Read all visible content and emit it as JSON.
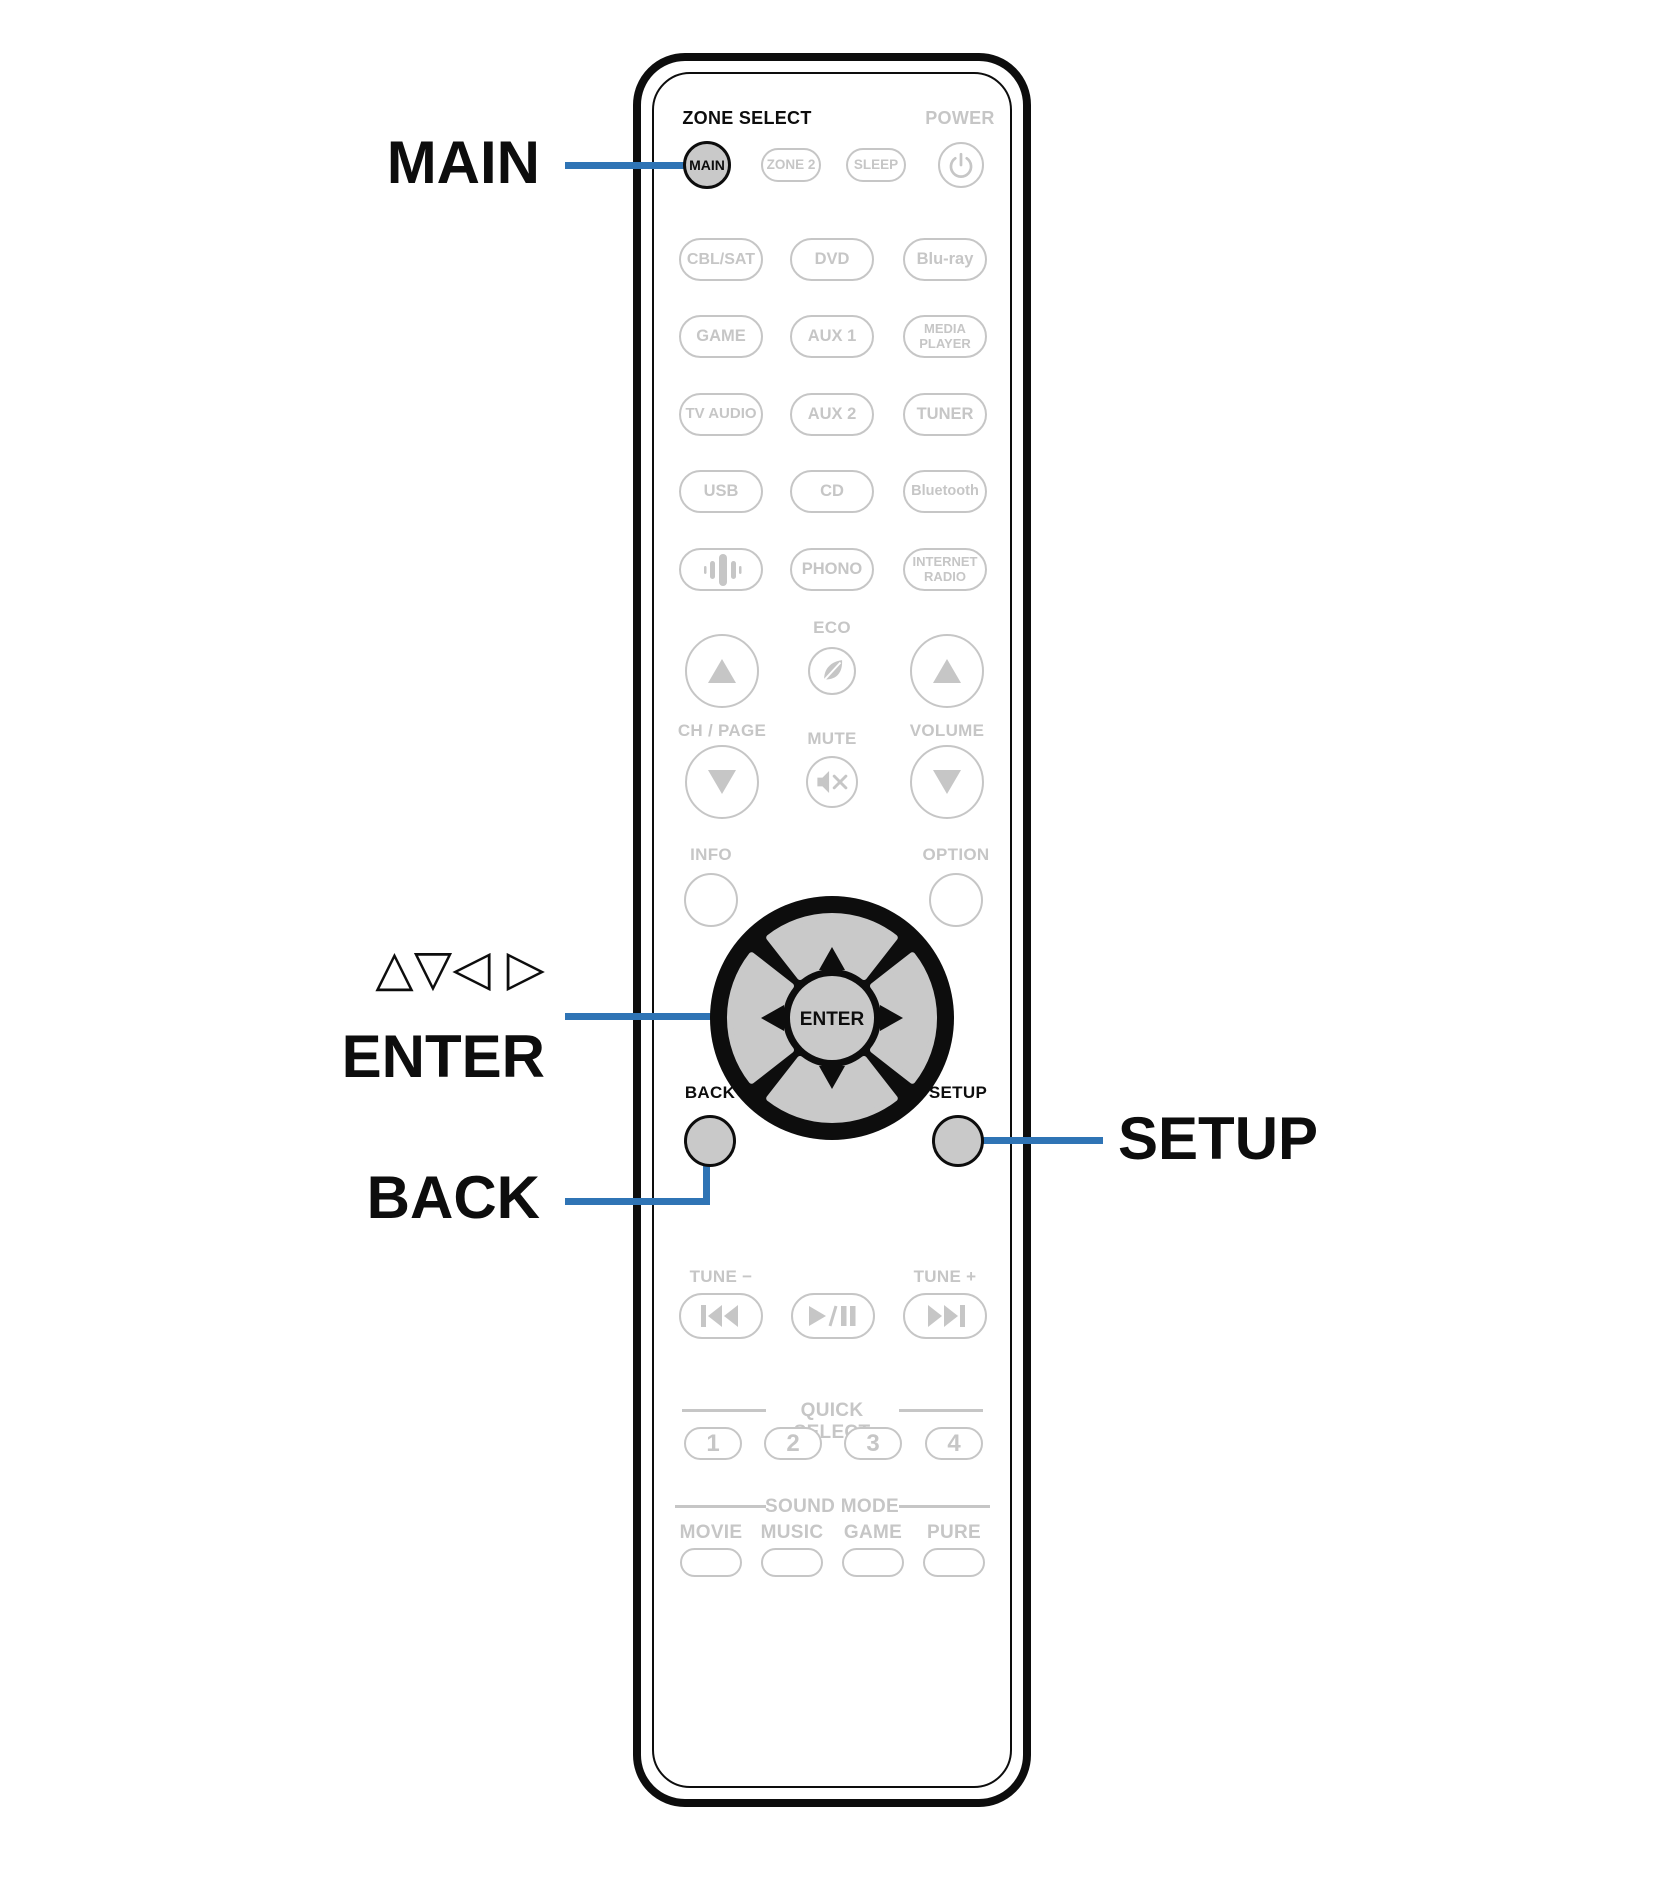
{
  "colors": {
    "accent_blue": "#2F74B5",
    "inactive_gray": "#C6C6C6",
    "button_fill_gray": "#C9C9C9",
    "outline_black": "#0D0D0D"
  },
  "callouts": {
    "main_label": "MAIN",
    "cursor_triangles": "△▽◁ ▷",
    "enter_label": "ENTER",
    "back_label": "BACK",
    "setup_label": "SETUP"
  },
  "remote": {
    "header": {
      "zone_select": "ZONE SELECT",
      "power": "POWER"
    },
    "zone_buttons": {
      "main": "MAIN",
      "zone2": "ZONE 2",
      "sleep": "SLEEP"
    },
    "sources": [
      {
        "label": "CBL/SAT"
      },
      {
        "label": "DVD"
      },
      {
        "label": "Blu-ray"
      },
      {
        "label": "GAME"
      },
      {
        "label": "AUX 1"
      },
      {
        "label": "MEDIA\nPLAYER"
      },
      {
        "label": "TV AUDIO"
      },
      {
        "label": "AUX 2"
      },
      {
        "label": "TUNER"
      },
      {
        "label": "USB"
      },
      {
        "label": "CD"
      },
      {
        "label": "Bluetooth"
      },
      {
        "label": "",
        "icon": "heos-icon"
      },
      {
        "label": "PHONO"
      },
      {
        "label": "INTERNET\nRADIO"
      }
    ],
    "center": {
      "eco": "ECO",
      "ch_page": "CH / PAGE",
      "mute": "MUTE",
      "volume": "VOLUME",
      "info": "INFO",
      "option": "OPTION"
    },
    "dpad": {
      "enter": "ENTER",
      "back": "BACK",
      "setup": "SETUP"
    },
    "transport": {
      "tune_minus": "TUNE −",
      "tune_plus": "TUNE +"
    },
    "quick_select": {
      "title": "QUICK SELECT",
      "buttons": [
        "1",
        "2",
        "3",
        "4"
      ]
    },
    "sound_mode": {
      "title": "SOUND MODE",
      "labels": [
        "MOVIE",
        "MUSIC",
        "GAME",
        "PURE"
      ]
    }
  }
}
